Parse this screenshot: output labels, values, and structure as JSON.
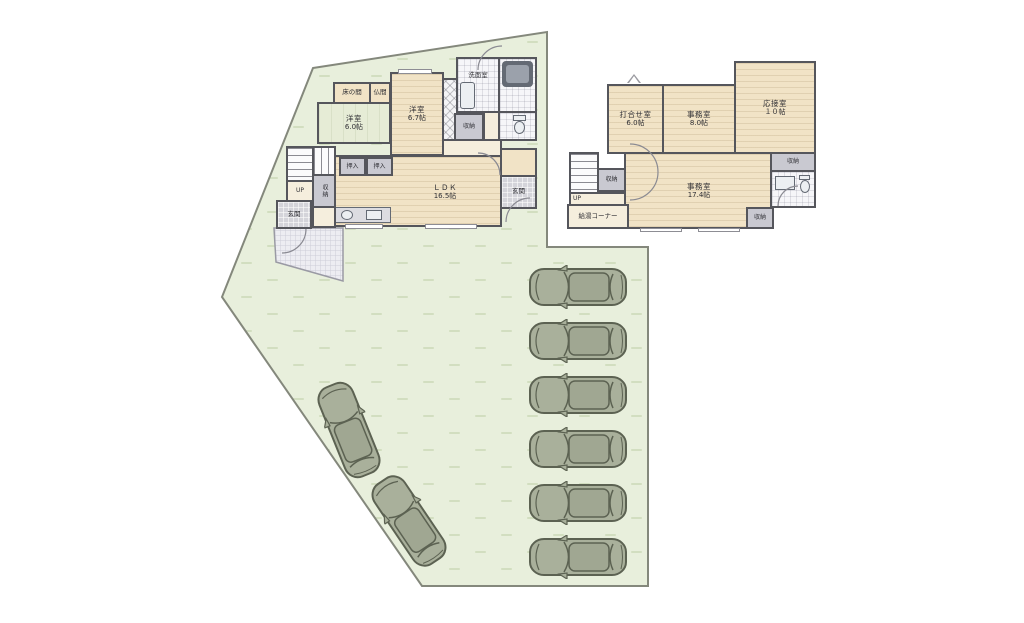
{
  "title": "site-and-floor-plan",
  "floor1": {
    "tokonoma": "床の間",
    "butsuma": "仏間",
    "yo60_name": "洋室",
    "yo60_size": "6.0帖",
    "yo67_name": "洋室",
    "yo67_size": "6.7帖",
    "senmen": "洗面室",
    "shuno_hall": "収納",
    "shuno_entry": "収納",
    "oshiire_a": "押入",
    "oshiire_b": "押入",
    "ldk_name": "ＬＤＫ",
    "ldk_size": "16.5帖",
    "genkan_right": "玄関",
    "genkan_left": "玄関",
    "up": "UP"
  },
  "floor2": {
    "uchiawase_name": "打合せ室",
    "uchiawase_size": "6.0帖",
    "jimu8_name": "事務室",
    "jimu8_size": "8.0帖",
    "ousetsu_name": "応接室",
    "ousetsu_size": "１０帖",
    "jimu17_name": "事務室",
    "jimu17_size": "17.4帖",
    "shuno_stairs": "収納",
    "shuno_right": "収納",
    "shuno_bottom": "収納",
    "up": "UP",
    "kyuto": "給湯コーナー"
  },
  "site": {
    "car_count": 8
  },
  "icons": {
    "car": "car-top-view"
  },
  "colors": {
    "wall": "#55565c",
    "site": "#e8efdc",
    "site_stroke": "#84887c",
    "room_tan": "#f1e3c6",
    "tatami": "#e6ecd6",
    "closet_gray": "#c9c9d1",
    "hall_cream": "#f5eedd",
    "tile_gray": "#d4d4da",
    "bath_white": "#f6f6f9",
    "fixture": "#646a74",
    "hatch": "#ededf2",
    "car_body": "#a9b09b",
    "car_roof": "#a0a792",
    "car_line": "#5c6252"
  }
}
